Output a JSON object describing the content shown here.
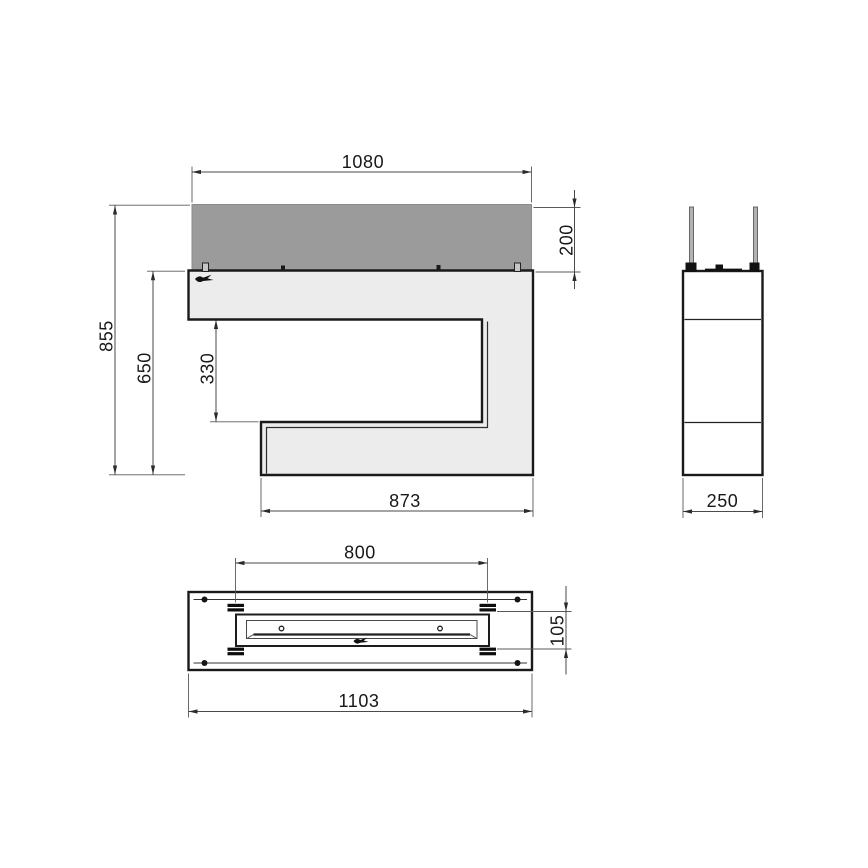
{
  "colors": {
    "glass_fill": "#9b9b9b",
    "body_fill": "#ececec",
    "line": "#1a1a1a",
    "background": "#ffffff"
  },
  "front_view": {
    "glass_width_mm": "1080",
    "glass_height_mm": "200",
    "overall_height_mm": "855",
    "body_height_mm": "650",
    "opening_height_mm": "330",
    "base_width_mm": "873"
  },
  "side_view": {
    "depth_mm": "250"
  },
  "bottom_view": {
    "mount_spacing_mm": "800",
    "burner_depth_mm": "105",
    "overall_width_mm": "1103"
  }
}
